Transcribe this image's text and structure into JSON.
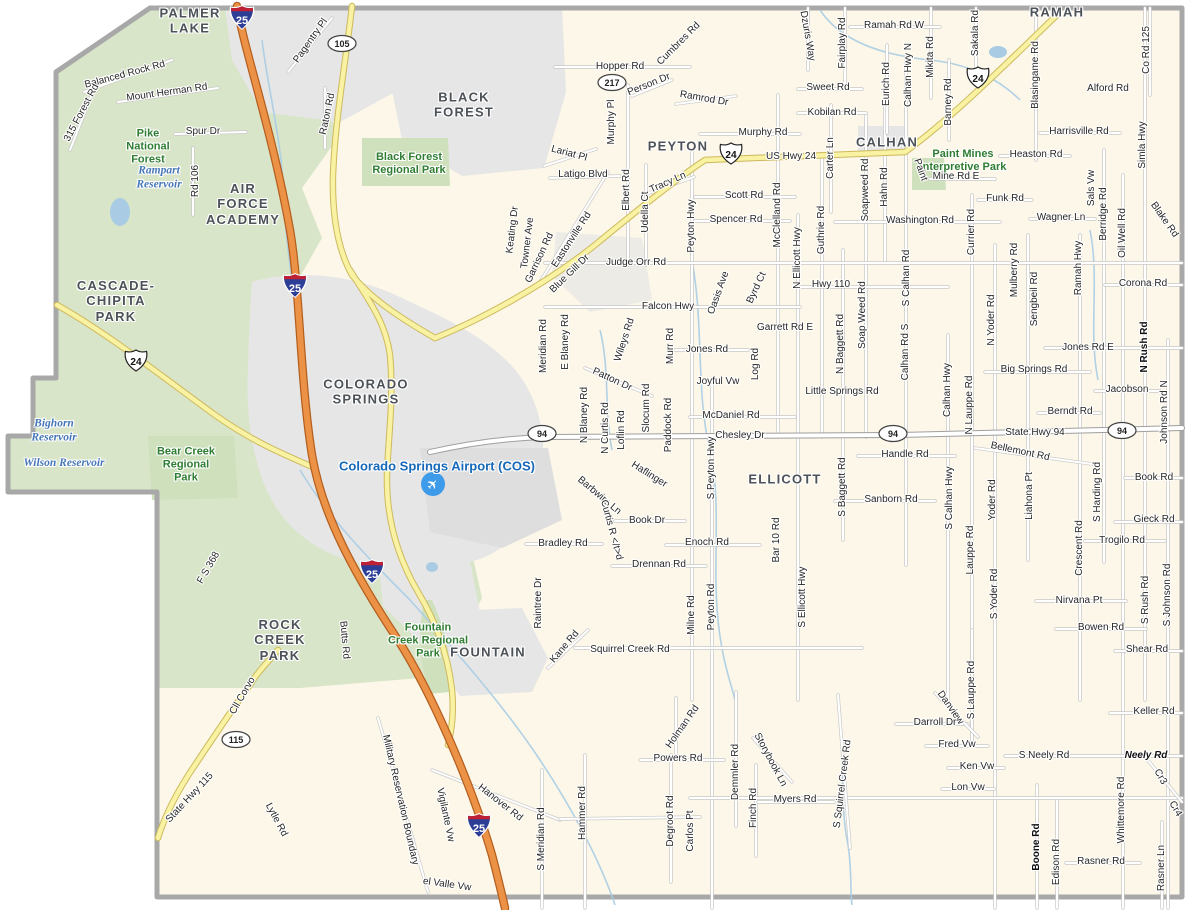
{
  "map": {
    "colors": {
      "county_fill": "#fcf7e8",
      "forest": "#d9e5c9",
      "urban": "#e6e6e6",
      "boundary": "#a8a8a8",
      "hwy_yellow": "#f8f2a2",
      "hwy_yellow_casing": "#cdb95e",
      "interstate_orange": "#ec9246",
      "interstate_casing": "#b55f1f",
      "water": "#a9cce4",
      "shield_blue": "#2d3e97",
      "shield_red": "#bf2033"
    },
    "airport_icon": {
      "glyph": "✈",
      "x": 433,
      "y": 484
    },
    "shields": [
      {
        "type": "interstate",
        "num": "25",
        "x": 242,
        "y": 20
      },
      {
        "type": "interstate",
        "num": "25",
        "x": 295,
        "y": 288
      },
      {
        "type": "interstate",
        "num": "25",
        "x": 372,
        "y": 574
      },
      {
        "type": "interstate",
        "num": "25",
        "x": 479,
        "y": 828
      },
      {
        "type": "us",
        "num": "24",
        "x": 136,
        "y": 363
      },
      {
        "type": "us",
        "num": "24",
        "x": 731,
        "y": 156
      },
      {
        "type": "us",
        "num": "24",
        "x": 978,
        "y": 80
      },
      {
        "type": "oval",
        "num": "105",
        "x": 342,
        "y": 46
      },
      {
        "type": "oval",
        "num": "217",
        "x": 612,
        "y": 85
      },
      {
        "type": "oval",
        "num": "115",
        "x": 236,
        "y": 742
      },
      {
        "type": "oval",
        "num": "94",
        "x": 542,
        "y": 436
      },
      {
        "type": "oval",
        "num": "94",
        "x": 893,
        "y": 436
      },
      {
        "type": "oval",
        "num": "94",
        "x": 1122,
        "y": 433
      }
    ],
    "labels": [
      {
        "t": "PALMER\nLAKE",
        "x": 190,
        "y": 21,
        "c": "city"
      },
      {
        "t": "BLACK\nFOREST",
        "x": 464,
        "y": 105,
        "c": "city"
      },
      {
        "t": "PEYTON",
        "x": 678,
        "y": 146,
        "c": "city"
      },
      {
        "t": "CALHAN",
        "x": 887,
        "y": 142,
        "c": "city"
      },
      {
        "t": "RAMAH",
        "x": 1057,
        "y": 12,
        "c": "city"
      },
      {
        "t": "AIR\nFORCE\nACADEMY",
        "x": 243,
        "y": 204,
        "c": "city"
      },
      {
        "t": "CASCADE-\nCHIPITA\nPARK",
        "x": 116,
        "y": 301,
        "c": "city"
      },
      {
        "t": "COLORADO\nSPRINGS",
        "x": 366,
        "y": 392,
        "c": "city"
      },
      {
        "t": "ELLICOTT",
        "x": 785,
        "y": 479,
        "c": "city"
      },
      {
        "t": "ROCK\nCREEK\nPARK",
        "x": 280,
        "y": 640,
        "c": "city"
      },
      {
        "t": "FOUNTAIN",
        "x": 488,
        "y": 652,
        "c": "city"
      },
      {
        "t": "Pike\nNational\nForest",
        "x": 148,
        "y": 147,
        "c": "park"
      },
      {
        "t": "Black Forest\nRegional Park",
        "x": 409,
        "y": 164,
        "c": "park"
      },
      {
        "t": "Paint Mines\nInterpretive Park",
        "x": 963,
        "y": 161,
        "c": "park"
      },
      {
        "t": "Bear Creek\nRegional\nPark",
        "x": 186,
        "y": 465,
        "c": "park"
      },
      {
        "t": "Fountain\nCreek Regional\nPark",
        "x": 428,
        "y": 641,
        "c": "park"
      },
      {
        "t": "Rampart\nReservoir",
        "x": 159,
        "y": 178,
        "c": "water"
      },
      {
        "t": "Bighorn\nReservoir",
        "x": 54,
        "y": 431,
        "c": "water"
      },
      {
        "t": "Wilson Reservoir",
        "x": 64,
        "y": 464,
        "c": "water"
      },
      {
        "t": "Colorado Springs Airport (COS)",
        "x": 437,
        "y": 466,
        "c": "airport"
      },
      {
        "t": "Pagentry Pl",
        "x": 311,
        "y": 41,
        "r": -55
      },
      {
        "t": "Balanced Rock Rd",
        "x": 125,
        "y": 75,
        "r": -15
      },
      {
        "t": "Mount Herman Rd",
        "x": 167,
        "y": 93,
        "r": -8
      },
      {
        "t": "315 Forest Rd",
        "x": 82,
        "y": 113,
        "r": -62
      },
      {
        "t": "Spur Dr",
        "x": 203,
        "y": 132
      },
      {
        "t": "Rd 106",
        "x": 196,
        "y": 181,
        "r": -90
      },
      {
        "t": "Raton Rd",
        "x": 328,
        "y": 114,
        "r": -78
      },
      {
        "t": "Hopper Rd",
        "x": 620,
        "y": 67
      },
      {
        "t": "Cumbres Rd",
        "x": 679,
        "y": 44,
        "r": -45
      },
      {
        "t": "Person Dr",
        "x": 649,
        "y": 85,
        "r": -22
      },
      {
        "t": "Ramrod Dr",
        "x": 704,
        "y": 99,
        "r": 10
      },
      {
        "t": "Murphy Pl",
        "x": 612,
        "y": 122,
        "r": -90
      },
      {
        "t": "Murphy Rd",
        "x": 763,
        "y": 133
      },
      {
        "t": "US Hwy 24",
        "x": 791,
        "y": 157
      },
      {
        "t": "Lariat Pl",
        "x": 569,
        "y": 154,
        "r": 15
      },
      {
        "t": "Latigo Blvd",
        "x": 583,
        "y": 175
      },
      {
        "t": "Elbert Rd",
        "x": 627,
        "y": 190,
        "r": -90
      },
      {
        "t": "Udella Ct",
        "x": 646,
        "y": 212,
        "r": -90
      },
      {
        "t": "Tracy Ln",
        "x": 668,
        "y": 183,
        "r": -24
      },
      {
        "t": "Peyton Hwy",
        "x": 692,
        "y": 226,
        "r": -90
      },
      {
        "t": "Scott Rd",
        "x": 744,
        "y": 196
      },
      {
        "t": "Spencer Rd",
        "x": 736,
        "y": 220
      },
      {
        "t": "McClelland Rd",
        "x": 778,
        "y": 215,
        "r": -90
      },
      {
        "t": "N Ellicott Hwy",
        "x": 798,
        "y": 258,
        "r": -90
      },
      {
        "t": "Guthrie Rd",
        "x": 822,
        "y": 230,
        "r": -90
      },
      {
        "t": "Carter Ln",
        "x": 831,
        "y": 158,
        "r": -90
      },
      {
        "t": "Soapweed Rd",
        "x": 866,
        "y": 190,
        "r": -90
      },
      {
        "t": "Hahn Rd",
        "x": 885,
        "y": 187,
        "r": -90
      },
      {
        "t": "Washington Rd",
        "x": 920,
        "y": 221
      },
      {
        "t": "Currier Rd",
        "x": 972,
        "y": 232,
        "r": -90
      },
      {
        "t": "Funk Rd",
        "x": 1005,
        "y": 199
      },
      {
        "t": "Judge Orr Rd",
        "x": 636,
        "y": 263
      },
      {
        "t": "Ramah Rd W",
        "x": 894,
        "y": 26
      },
      {
        "t": "Dzuris Way",
        "x": 807,
        "y": 36,
        "r": 80
      },
      {
        "t": "Fairplay Rd",
        "x": 843,
        "y": 43,
        "r": -90
      },
      {
        "t": "Eurich Rd",
        "x": 887,
        "y": 84,
        "r": -90
      },
      {
        "t": "Calhan Hwy N",
        "x": 909,
        "y": 75,
        "r": -90
      },
      {
        "t": "Mikita Rd",
        "x": 931,
        "y": 57,
        "r": -90
      },
      {
        "t": "Barney Rd",
        "x": 949,
        "y": 102,
        "r": -90
      },
      {
        "t": "Sakala Rd",
        "x": 976,
        "y": 33,
        "r": -90
      },
      {
        "t": "Blasingame Rd",
        "x": 1036,
        "y": 75,
        "r": -90
      },
      {
        "t": "Sweet Rd",
        "x": 828,
        "y": 88
      },
      {
        "t": "Kobilan Rd",
        "x": 832,
        "y": 113
      },
      {
        "t": "Alford Rd",
        "x": 1108,
        "y": 89
      },
      {
        "t": "Harrisville Rd",
        "x": 1079,
        "y": 132
      },
      {
        "t": "Heaston Rd",
        "x": 1036,
        "y": 155
      },
      {
        "t": "Paint",
        "x": 920,
        "y": 170,
        "r": 70
      },
      {
        "t": "Mine Rd E",
        "x": 956,
        "y": 177
      },
      {
        "t": "Co Rd 125",
        "x": 1147,
        "y": 50,
        "r": -90
      },
      {
        "t": "Simla Hwy",
        "x": 1143,
        "y": 145,
        "r": -90
      },
      {
        "t": "Blake Rd",
        "x": 1164,
        "y": 220,
        "r": 55
      },
      {
        "t": "Sals Vw",
        "x": 1092,
        "y": 188,
        "r": -90
      },
      {
        "t": "Berridge Rd",
        "x": 1104,
        "y": 214,
        "r": -90
      },
      {
        "t": "Oil Well Rd",
        "x": 1123,
        "y": 233,
        "r": -90
      },
      {
        "t": "Wagner Ln",
        "x": 1061,
        "y": 218
      },
      {
        "t": "Ramah Hwy",
        "x": 1079,
        "y": 268,
        "r": -90
      },
      {
        "t": "Corona Rd",
        "x": 1143,
        "y": 284
      },
      {
        "t": "Keating Dr",
        "x": 513,
        "y": 230,
        "r": -83
      },
      {
        "t": "Towner Ave",
        "x": 528,
        "y": 243,
        "r": -83
      },
      {
        "t": "Garrison Rd",
        "x": 540,
        "y": 258,
        "r": -65
      },
      {
        "t": "Eastonville Rd",
        "x": 572,
        "y": 240,
        "r": -57
      },
      {
        "t": "Blue Gill Dr",
        "x": 570,
        "y": 274,
        "r": -44
      },
      {
        "t": "Falcon Hwy",
        "x": 668,
        "y": 307
      },
      {
        "t": "Oasis Ave",
        "x": 719,
        "y": 293,
        "r": -70
      },
      {
        "t": "Byrd Ct",
        "x": 757,
        "y": 288,
        "r": -65
      },
      {
        "t": "Meridian Rd",
        "x": 544,
        "y": 346,
        "r": -90
      },
      {
        "t": "E Blaney Rd",
        "x": 566,
        "y": 342,
        "r": -90
      },
      {
        "t": "Wileys Rd",
        "x": 625,
        "y": 340,
        "r": -72
      },
      {
        "t": "Murr Rd",
        "x": 671,
        "y": 346,
        "r": -90
      },
      {
        "t": "Jones Rd",
        "x": 707,
        "y": 350
      },
      {
        "t": "Garrett Rd E",
        "x": 785,
        "y": 328
      },
      {
        "t": "Patton Dr",
        "x": 612,
        "y": 380,
        "r": 25
      },
      {
        "t": "Joyful Vw",
        "x": 718,
        "y": 382
      },
      {
        "t": "Log Rd",
        "x": 756,
        "y": 364,
        "r": -90
      },
      {
        "t": "Hwy 110",
        "x": 831,
        "y": 285
      },
      {
        "t": "N Baggett Rd",
        "x": 841,
        "y": 344,
        "r": -90
      },
      {
        "t": "Soap Weed Rd",
        "x": 863,
        "y": 315,
        "r": -90
      },
      {
        "t": "Little Springs Rd",
        "x": 842,
        "y": 392
      },
      {
        "t": "Calhan Rd S",
        "x": 906,
        "y": 352,
        "r": -90
      },
      {
        "t": "S Calhan Rd",
        "x": 907,
        "y": 278,
        "r": -90
      },
      {
        "t": "Mulberry Rd",
        "x": 1015,
        "y": 270,
        "r": -90
      },
      {
        "t": "Sengbeil Rd",
        "x": 1035,
        "y": 299,
        "r": -90
      },
      {
        "t": "N Yoder Rd",
        "x": 992,
        "y": 320,
        "r": -90
      },
      {
        "t": "Jones Rd E",
        "x": 1088,
        "y": 348
      },
      {
        "t": "Big Springs Rd",
        "x": 1034,
        "y": 370
      },
      {
        "t": "Jacobson",
        "x": 1127,
        "y": 390
      },
      {
        "t": "Berndt Rd",
        "x": 1070,
        "y": 412
      },
      {
        "t": "N Rush Rd",
        "x": 1145,
        "y": 347,
        "r": -90,
        "c": "roadb"
      },
      {
        "t": "Johnson Rd N",
        "x": 1165,
        "y": 412,
        "r": -90
      },
      {
        "t": "N Blaney Rd",
        "x": 585,
        "y": 415,
        "r": -90
      },
      {
        "t": "N Curtis Rd",
        "x": 606,
        "y": 428,
        "r": -90
      },
      {
        "t": "Loflin Rd",
        "x": 622,
        "y": 430,
        "r": -90
      },
      {
        "t": "Slocum Rd",
        "x": 647,
        "y": 408,
        "r": -90
      },
      {
        "t": "Paddock Rd",
        "x": 669,
        "y": 425,
        "r": -90
      },
      {
        "t": "McDaniel Rd",
        "x": 731,
        "y": 416
      },
      {
        "t": "Chesley Dr",
        "x": 740,
        "y": 436
      },
      {
        "t": "State Hwy 94",
        "x": 1035,
        "y": 433
      },
      {
        "t": "Calhan Hwy",
        "x": 948,
        "y": 390,
        "r": -90
      },
      {
        "t": "N Lauppe Rd",
        "x": 970,
        "y": 405,
        "r": -90
      },
      {
        "t": "Bellemont Rd",
        "x": 1020,
        "y": 452,
        "r": 12
      },
      {
        "t": "Handle Rd",
        "x": 905,
        "y": 455
      },
      {
        "t": "Haflinger",
        "x": 649,
        "y": 475,
        "r": 32
      },
      {
        "t": "Barbwire Ln",
        "x": 599,
        "y": 496,
        "r": 40
      },
      {
        "t": "Curtis R </t>d",
        "x": 611,
        "y": 530,
        "r": 75
      },
      {
        "t": "S Peyton Hwy",
        "x": 712,
        "y": 468,
        "r": -90
      },
      {
        "t": "Sanborn Rd",
        "x": 891,
        "y": 500
      },
      {
        "t": "S Baggett Rd",
        "x": 843,
        "y": 487,
        "r": -90
      },
      {
        "t": "S Calhan Hwy",
        "x": 950,
        "y": 498,
        "r": -90
      },
      {
        "t": "Lauppe Rd",
        "x": 971,
        "y": 550,
        "r": -90
      },
      {
        "t": "Yoder Rd",
        "x": 993,
        "y": 500,
        "r": -90
      },
      {
        "t": "S Yoder Rd",
        "x": 995,
        "y": 594,
        "r": -90
      },
      {
        "t": "Liahona Pt",
        "x": 1030,
        "y": 496,
        "r": -90
      },
      {
        "t": "S Harding Rd",
        "x": 1098,
        "y": 492,
        "r": -90
      },
      {
        "t": "Book Rd",
        "x": 1154,
        "y": 478
      },
      {
        "t": "Gieck Rd",
        "x": 1154,
        "y": 520
      },
      {
        "t": "Trogilo Rd",
        "x": 1122,
        "y": 541
      },
      {
        "t": "Crescent Rd",
        "x": 1080,
        "y": 548,
        "r": -90
      },
      {
        "t": "Nirvana Pt",
        "x": 1079,
        "y": 601
      },
      {
        "t": "S Rush Rd",
        "x": 1146,
        "y": 600,
        "r": -90
      },
      {
        "t": "S Johnson Rd",
        "x": 1168,
        "y": 595,
        "r": -90
      },
      {
        "t": "Bowen Rd",
        "x": 1101,
        "y": 628
      },
      {
        "t": "Shear Rd",
        "x": 1147,
        "y": 650
      },
      {
        "t": "Book Dr",
        "x": 647,
        "y": 521
      },
      {
        "t": "Bradley Rd",
        "x": 563,
        "y": 544
      },
      {
        "t": "Enoch Rd",
        "x": 707,
        "y": 543
      },
      {
        "t": "Drennan Rd",
        "x": 659,
        "y": 565
      },
      {
        "t": "Bar 10 Rd",
        "x": 777,
        "y": 540,
        "r": -90
      },
      {
        "t": "S Ellicott Hwy",
        "x": 803,
        "y": 597,
        "r": -90
      },
      {
        "t": "Milne Rd",
        "x": 692,
        "y": 615,
        "r": -90
      },
      {
        "t": "Peyton Rd",
        "x": 712,
        "y": 607,
        "r": -90
      },
      {
        "t": "Raintree Dr",
        "x": 539,
        "y": 603,
        "r": -90
      },
      {
        "t": "Kane Rd",
        "x": 565,
        "y": 647,
        "r": -50
      },
      {
        "t": "Squirrel Creek Rd",
        "x": 630,
        "y": 650
      },
      {
        "t": "F S 368",
        "x": 209,
        "y": 568,
        "r": -60
      },
      {
        "t": "Butts Rd",
        "x": 344,
        "y": 640,
        "r": 85
      },
      {
        "t": "Cll Corvo",
        "x": 243,
        "y": 696,
        "r": -60
      },
      {
        "t": "State Hwy 115",
        "x": 190,
        "y": 798,
        "r": -47
      },
      {
        "t": "Lytle Rd",
        "x": 276,
        "y": 820,
        "r": 62
      },
      {
        "t": "Military Reservation Boundary",
        "x": 400,
        "y": 800,
        "r": 77
      },
      {
        "t": "Vigilante Vw",
        "x": 445,
        "y": 815,
        "r": 78
      },
      {
        "t": "el Valle Vw",
        "x": 447,
        "y": 885,
        "r": 8
      },
      {
        "t": "Hanover Rd",
        "x": 500,
        "y": 803,
        "r": 38
      },
      {
        "t": "S Meridian Rd",
        "x": 542,
        "y": 839,
        "r": -90
      },
      {
        "t": "Hammer Rd",
        "x": 583,
        "y": 813,
        "r": -90
      },
      {
        "t": "Holman Rd",
        "x": 683,
        "y": 727,
        "r": -55
      },
      {
        "t": "Powers Rd",
        "x": 678,
        "y": 759
      },
      {
        "t": "Degroot Rd",
        "x": 671,
        "y": 821,
        "r": -90
      },
      {
        "t": "Carlos Pt",
        "x": 691,
        "y": 831,
        "r": -90
      },
      {
        "t": "Demmler Rd",
        "x": 736,
        "y": 772,
        "r": -90
      },
      {
        "t": "Finch Rd",
        "x": 754,
        "y": 808,
        "r": -90
      },
      {
        "t": "Storybook Ln",
        "x": 770,
        "y": 760,
        "r": 62
      },
      {
        "t": "Myers Rd",
        "x": 795,
        "y": 800
      },
      {
        "t": "S Squirrel Creek Rd",
        "x": 843,
        "y": 784,
        "r": -83
      },
      {
        "t": "Danview",
        "x": 950,
        "y": 708,
        "r": 55
      },
      {
        "t": "S Lauppe Rd",
        "x": 972,
        "y": 690,
        "r": -90
      },
      {
        "t": "Darroll Dr",
        "x": 935,
        "y": 723
      },
      {
        "t": "Fred Vw",
        "x": 957,
        "y": 745
      },
      {
        "t": "Ken Vw",
        "x": 977,
        "y": 767
      },
      {
        "t": "Lon Vw",
        "x": 968,
        "y": 788
      },
      {
        "t": "S Neely Rd",
        "x": 1044,
        "y": 756
      },
      {
        "t": "Neely Rd",
        "x": 1146,
        "y": 756,
        "c": "roadbi"
      },
      {
        "t": "Keller Rd",
        "x": 1154,
        "y": 712
      },
      {
        "t": "Cr3",
        "x": 1160,
        "y": 777,
        "r": 60
      },
      {
        "t": "Cr4",
        "x": 1175,
        "y": 809,
        "r": 60
      },
      {
        "t": "Whittemore Rd",
        "x": 1122,
        "y": 810,
        "r": -90
      },
      {
        "t": "Boone Rd",
        "x": 1037,
        "y": 847,
        "r": -90,
        "c": "roadb"
      },
      {
        "t": "Edison Rd",
        "x": 1057,
        "y": 862,
        "r": -90
      },
      {
        "t": "Rasner Rd",
        "x": 1101,
        "y": 862
      },
      {
        "t": "Rasner Ln",
        "x": 1162,
        "y": 868,
        "r": -90
      }
    ]
  }
}
